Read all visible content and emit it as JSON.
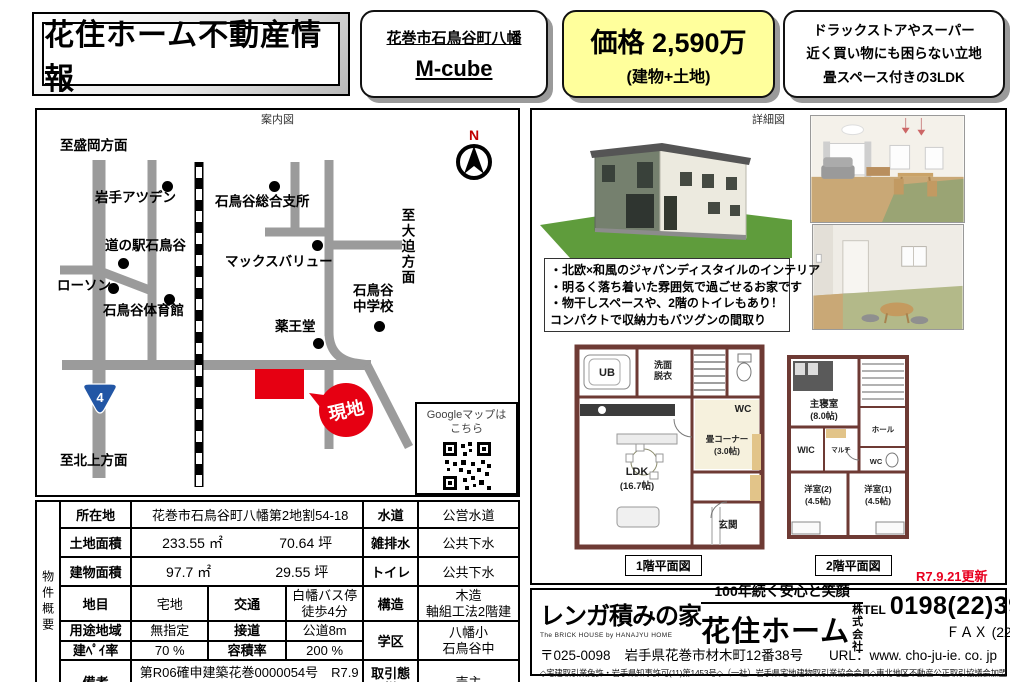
{
  "header": {
    "title": "花住ホーム不動産情報",
    "location_line": "花巻市石鳥谷町八幡",
    "product_name": "M-cube",
    "price_main": "価格 2,590万",
    "price_sub": "(建物+土地)",
    "features": [
      "ドラックストアやスーパー",
      "近く買い物にも困らない立地",
      "畳スペース付きの3LDK"
    ]
  },
  "map": {
    "caption": "案内図",
    "compass_n": "N",
    "route_shield": "4",
    "site_label": "現地",
    "google_line1": "Googleマップは",
    "google_line2": "こちら",
    "labels": {
      "morioka": "至盛岡方面",
      "atsuden": "岩手アツデン",
      "shisho": "石鳥谷総合支所",
      "michinoeki": "道の駅石鳥谷",
      "maxvalu": "マックスバリュー",
      "lawson": "ローソン",
      "gym": "石鳥谷体育館",
      "chugakko1": "石鳥谷",
      "chugakko2": "中学校",
      "yakuodo": "薬王堂",
      "osako": "至大迫方面",
      "kitakami": "至北上方面"
    }
  },
  "table": {
    "side_label": "物件概要",
    "location_label": "所在地",
    "location_value": "花巻市石鳥谷町八幡第2地割54-18",
    "water_label": "水道",
    "water_value": "公営水道",
    "land_label": "土地面積",
    "land_m2": "233.55 ㎡",
    "land_tsubo": "70.64 坪",
    "drain_label": "雑排水",
    "drain_value": "公共下水",
    "bldg_label": "建物面積",
    "bldg_m2": "97.7 ㎡",
    "bldg_tsubo": "29.55 坪",
    "toilet_label": "トイレ",
    "toilet_value": "公共下水",
    "landcat_label": "地目",
    "landcat_value": "宅地",
    "traffic_label": "交通",
    "traffic_value1": "白幡バス停",
    "traffic_value2": "徒歩4分",
    "structure_label": "構造",
    "structure_value1": "木造",
    "structure_value2": "軸組工法2階建",
    "zone_label": "用途地域",
    "zone_value": "無指定",
    "road_label": "接道",
    "road_value": "公道8m",
    "district_label": "学区",
    "district_value1": "八幡小",
    "district_value2": "石鳥谷中",
    "coverage_label": "建ﾍﾟｲ率",
    "coverage_value": "70 %",
    "far_label": "容積率",
    "far_value": "200 %",
    "notes_label": "備考",
    "notes_value": "第R06確申建築花巻0000054号　R7.9月完成",
    "deal_label": "取引態様",
    "deal_value": "売主"
  },
  "detail": {
    "caption": "詳細図",
    "bullets": [
      "・北欧×和風のジャパンディスタイルのインテリア",
      "・明るく落ち着いた雰囲気で過ごせるお家です",
      "・物干しスペースや、2階のトイレもあり！",
      "コンパクトで収納力もバツグンの間取り"
    ],
    "floor1_caption": "1階平面図",
    "floor2_caption": "2階平面図",
    "updated": "R7.9.21更新",
    "floor1": {
      "ub": "UB",
      "wash1": "洗面",
      "wash2": "脱衣",
      "wc": "WC",
      "tatami1": "畳コーナー",
      "tatami2": "(3.0帖)",
      "ldk1": "LDK",
      "ldk2": "(16.7帖)",
      "entrance": "玄関"
    },
    "floor2": {
      "master1": "主寝室",
      "master2": "(8.0帖)",
      "wic": "WIC",
      "multi": "マルチ",
      "hall": "ホール",
      "wc": "WC",
      "west2a": "洋室(2)",
      "west2b": "(4.5帖)",
      "west1a": "洋室(1)",
      "west1b": "(4.5帖)"
    }
  },
  "footer": {
    "brand": "レンガ積みの家",
    "brand_sub": "The BRICK HOUSE by HANAJYU HOME",
    "slogan": "100年続く安心と笑顔",
    "company": "花住ホーム",
    "suffix1": "株式",
    "suffix2": "会社",
    "tel_label": "TEL",
    "tel_number": "0198(22)3940",
    "fax_line": "ＦＡＸ (22) 3061",
    "zip": "〒025-0098",
    "address": "岩手県花巻市材木町12番38号",
    "url": "URL：www. cho-ju-ie. co. jp",
    "license": "◇宅建取引業免許・岩手県知事許可(11)第1453号◇（一社）岩手県宅地建物取引業協会会員◇東北地区不動産公正取引協議会加盟"
  },
  "colors": {
    "accent_yellow": "#ffff9c",
    "site_red": "#e60012",
    "road_gray": "#9b9b9b",
    "wall_maroon": "#6e3a34"
  }
}
